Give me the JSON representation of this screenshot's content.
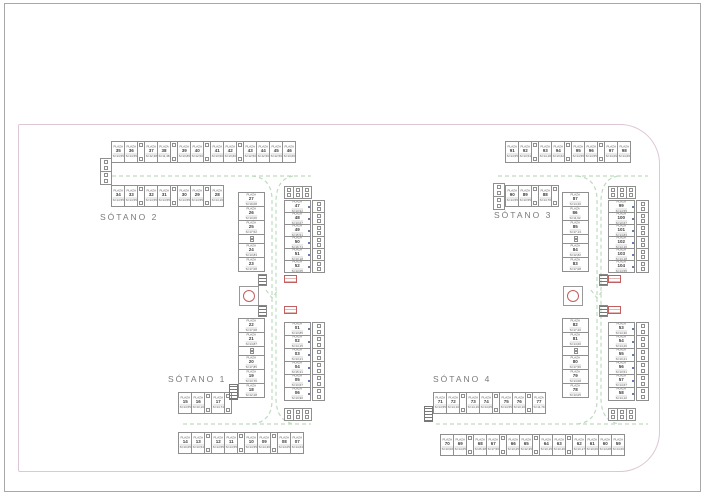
{
  "labels": {
    "s1": "SÓTANO 1",
    "s2": "SÓTANO 2",
    "s3": "SÓTANO 3",
    "s4": "SÓTANO 4"
  },
  "cell_text": {
    "plaza_word": "PLAZA"
  },
  "colors": {
    "background": "#ffffff",
    "frame_border": "#a8a8a8",
    "sheet_border": "#ddc6d6",
    "cell_border": "#8f8f8f",
    "text_dark": "#3e3e3e",
    "text_gray": "#7a7a7a",
    "lane_green": "#bfdbbf",
    "accent_red": "#c25f5f",
    "accent_blue": "#6a79b4"
  },
  "strips": [
    {
      "id": "s2-top-row",
      "x": 111,
      "y": 141,
      "o": "h",
      "cross": 22,
      "pw": 14,
      "uw": 8,
      "cells": [
        {
          "t": "p",
          "n": "35",
          "a": "S=14,55"
        },
        {
          "t": "p",
          "n": "36",
          "a": "S=14,55"
        },
        {
          "t": "u"
        },
        {
          "t": "p",
          "n": "37",
          "a": "S=12,38"
        },
        {
          "t": "p",
          "n": "38",
          "a": "S=11,38"
        },
        {
          "t": "u"
        },
        {
          "t": "p",
          "n": "39",
          "a": "S=13,86"
        },
        {
          "t": "p",
          "n": "40",
          "a": "S=12,50"
        },
        {
          "t": "u"
        },
        {
          "t": "p",
          "n": "41",
          "a": "S=13,50"
        },
        {
          "t": "p",
          "n": "42",
          "a": "S=13,60"
        },
        {
          "t": "u"
        },
        {
          "t": "p",
          "n": "43",
          "a": "S=12,50"
        },
        {
          "t": "p",
          "n": "44",
          "a": "S=12,50"
        },
        {
          "t": "p",
          "n": "45",
          "a": "S=12,50"
        },
        {
          "t": "p",
          "n": "46",
          "a": "S=13,66"
        }
      ]
    },
    {
      "id": "s2-left-block",
      "x": 100,
      "y": 158,
      "o": "v",
      "cross": 12,
      "pw": 14,
      "uw": 14,
      "cells": [
        {
          "t": "u"
        },
        {
          "t": "u"
        }
      ]
    },
    {
      "id": "s2-row-2",
      "x": 111,
      "y": 185,
      "o": "h",
      "cross": 22,
      "pw": 14,
      "uw": 8,
      "cells": [
        {
          "t": "p",
          "n": "34",
          "a": "S=14,55"
        },
        {
          "t": "p",
          "n": "33",
          "a": "S=14,55"
        },
        {
          "t": "u"
        },
        {
          "t": "p",
          "n": "32",
          "a": "S=14,55"
        },
        {
          "t": "p",
          "n": "31",
          "a": "S=14,55"
        },
        {
          "t": "u"
        },
        {
          "t": "p",
          "n": "30",
          "a": "S=14,55"
        },
        {
          "t": "p",
          "n": "29",
          "a": "S=14,55"
        },
        {
          "t": "u"
        },
        {
          "t": "p",
          "n": "28",
          "a": "S=14,16"
        }
      ]
    },
    {
      "id": "s2-col-left",
      "x": 238,
      "y": 192,
      "o": "v",
      "cross": 27,
      "pw": 15,
      "uw": 10,
      "cells": [
        {
          "t": "p",
          "n": "27",
          "a": "S=19,08"
        },
        {
          "t": "p",
          "n": "26",
          "a": "S=13,06"
        },
        {
          "t": "p",
          "n": "25",
          "a": "S=17,52"
        },
        {
          "t": "u"
        },
        {
          "t": "p",
          "n": "24",
          "a": "S=13,83"
        },
        {
          "t": "p",
          "n": "23",
          "a": "S=17,08"
        }
      ]
    },
    {
      "id": "s2-col-utils-top",
      "x": 284,
      "y": 186,
      "o": "h",
      "cross": 13,
      "pw": 10,
      "uw": 10,
      "cells": [
        {
          "t": "u"
        },
        {
          "t": "u"
        },
        {
          "t": "u"
        }
      ]
    },
    {
      "id": "s2-col-right",
      "x": 284,
      "y": 200,
      "o": "v",
      "cross": 27,
      "pw": 13,
      "uw": 8,
      "acc": "blue",
      "cells": [
        {
          "t": "p",
          "n": "47",
          "a": "S=13,92"
        },
        {
          "t": "p",
          "n": "48",
          "a": "S=13,67"
        },
        {
          "t": "p",
          "n": "49",
          "a": "S=15,51"
        },
        {
          "t": "p",
          "n": "50",
          "a": "S=16,71"
        },
        {
          "t": "p",
          "n": "51",
          "a": "S=13,18"
        },
        {
          "t": "p",
          "n": "52",
          "a": "S=13,65"
        }
      ]
    },
    {
      "id": "s2-col-right-utils",
      "x": 312,
      "y": 200,
      "o": "v",
      "cross": 13,
      "pw": 13,
      "uw": 13,
      "cells": [
        {
          "t": "u"
        },
        {
          "t": "u"
        },
        {
          "t": "u"
        },
        {
          "t": "u"
        },
        {
          "t": "u"
        },
        {
          "t": "u"
        }
      ]
    },
    {
      "id": "s1-col-left",
      "x": 238,
      "y": 318,
      "o": "v",
      "cross": 27,
      "pw": 15,
      "uw": 10,
      "cells": [
        {
          "t": "p",
          "n": "22",
          "a": "S=17,08"
        },
        {
          "t": "p",
          "n": "21",
          "a": "S=14,87"
        },
        {
          "t": "u"
        },
        {
          "t": "p",
          "n": "20",
          "a": "S=17,85"
        },
        {
          "t": "p",
          "n": "19",
          "a": "S=13,76"
        },
        {
          "t": "p",
          "n": "18",
          "a": "S=12,28"
        }
      ]
    },
    {
      "id": "s1-col-right",
      "x": 284,
      "y": 322,
      "o": "v",
      "cross": 27,
      "pw": 14,
      "uw": 8,
      "acc": "blue",
      "cells": [
        {
          "t": "p",
          "n": "01",
          "a": "S=13,85"
        },
        {
          "t": "p",
          "n": "02",
          "a": "S=14,15"
        },
        {
          "t": "p",
          "n": "03",
          "a": "S=13,21"
        },
        {
          "t": "p",
          "n": "04",
          "a": "S=15,31"
        },
        {
          "t": "p",
          "n": "05",
          "a": "S=13,67"
        },
        {
          "t": "p",
          "n": "06",
          "a": "S=13,90"
        }
      ]
    },
    {
      "id": "s1-col-right-utils",
      "x": 312,
      "y": 322,
      "o": "v",
      "cross": 13,
      "pw": 14,
      "uw": 14,
      "cells": [
        {
          "t": "u"
        },
        {
          "t": "u"
        },
        {
          "t": "u"
        },
        {
          "t": "u"
        },
        {
          "t": "u"
        },
        {
          "t": "u"
        }
      ]
    },
    {
      "id": "s1-col-bottom-utils",
      "x": 284,
      "y": 408,
      "o": "h",
      "cross": 13,
      "pw": 10,
      "uw": 10,
      "cells": [
        {
          "t": "u"
        },
        {
          "t": "u"
        },
        {
          "t": "u"
        }
      ]
    },
    {
      "id": "s1-row-mid",
      "x": 178,
      "y": 392,
      "o": "h",
      "cross": 22,
      "pw": 14,
      "uw": 8,
      "cells": [
        {
          "t": "p",
          "n": "15",
          "a": "S=14,55"
        },
        {
          "t": "p",
          "n": "16",
          "a": "S=13,10"
        },
        {
          "t": "u"
        },
        {
          "t": "p",
          "n": "17",
          "a": "S=14,74"
        },
        {
          "t": "u"
        }
      ]
    },
    {
      "id": "s1-row-bottom",
      "x": 178,
      "y": 432,
      "o": "h",
      "cross": 22,
      "pw": 14,
      "uw": 8,
      "cells": [
        {
          "t": "p",
          "n": "14",
          "a": "S=13,05"
        },
        {
          "t": "p",
          "n": "13",
          "a": "S=13,54"
        },
        {
          "t": "u"
        },
        {
          "t": "p",
          "n": "12",
          "a": "S=14,55"
        },
        {
          "t": "p",
          "n": "11",
          "a": "S=14,55"
        },
        {
          "t": "u"
        },
        {
          "t": "p",
          "n": "10",
          "a": "S=14,55"
        },
        {
          "t": "p",
          "n": "09",
          "a": "S=14,36"
        },
        {
          "t": "u"
        },
        {
          "t": "p",
          "n": "08",
          "a": "S=14,05"
        },
        {
          "t": "p",
          "n": "07",
          "a": "S=14,64"
        }
      ]
    },
    {
      "id": "s3-top-row",
      "x": 505,
      "y": 141,
      "o": "h",
      "cross": 22,
      "pw": 14,
      "uw": 8,
      "cells": [
        {
          "t": "p",
          "n": "91",
          "a": "S=14,55"
        },
        {
          "t": "p",
          "n": "92",
          "a": "S=13,54"
        },
        {
          "t": "u"
        },
        {
          "t": "p",
          "n": "93",
          "a": "S=14,18"
        },
        {
          "t": "p",
          "n": "94",
          "a": "S=13,62"
        },
        {
          "t": "u"
        },
        {
          "t": "p",
          "n": "95",
          "a": "S=14,55"
        },
        {
          "t": "p",
          "n": "96",
          "a": "S=14,55"
        },
        {
          "t": "u"
        },
        {
          "t": "p",
          "n": "97",
          "a": "S=14,09"
        },
        {
          "t": "p",
          "n": "98",
          "a": "S=14,66"
        }
      ]
    },
    {
      "id": "s3-left-block",
      "x": 493,
      "y": 183,
      "o": "v",
      "cross": 12,
      "pw": 14,
      "uw": 14,
      "cells": [
        {
          "t": "u"
        },
        {
          "t": "u"
        }
      ]
    },
    {
      "id": "s3-row-2",
      "x": 505,
      "y": 185,
      "o": "h",
      "cross": 22,
      "pw": 14,
      "uw": 8,
      "cells": [
        {
          "t": "p",
          "n": "90",
          "a": "S=14,55"
        },
        {
          "t": "p",
          "n": "89",
          "a": "S=13,55"
        },
        {
          "t": "u"
        },
        {
          "t": "p",
          "n": "88",
          "a": "S=14,76"
        },
        {
          "t": "u"
        }
      ]
    },
    {
      "id": "s3-col-left",
      "x": 562,
      "y": 192,
      "o": "v",
      "cross": 27,
      "pw": 15,
      "uw": 10,
      "cells": [
        {
          "t": "p",
          "n": "87",
          "a": "S=14,20"
        },
        {
          "t": "p",
          "n": "86",
          "a": "S=11,62"
        },
        {
          "t": "p",
          "n": "85",
          "a": "S=17,13"
        },
        {
          "t": "u"
        },
        {
          "t": "p",
          "n": "84",
          "a": "S=12,82"
        },
        {
          "t": "p",
          "n": "83",
          "a": "S=17,08"
        }
      ]
    },
    {
      "id": "s3-col-utils-top",
      "x": 608,
      "y": 186,
      "o": "h",
      "cross": 13,
      "pw": 10,
      "uw": 10,
      "cells": [
        {
          "t": "u"
        },
        {
          "t": "u"
        },
        {
          "t": "u"
        }
      ]
    },
    {
      "id": "s3-col-right",
      "x": 608,
      "y": 200,
      "o": "v",
      "cross": 27,
      "pw": 13,
      "uw": 8,
      "acc": "blue",
      "cells": [
        {
          "t": "p",
          "n": "99",
          "a": "S=14,55"
        },
        {
          "t": "p",
          "n": "100",
          "a": "S=13,67"
        },
        {
          "t": "p",
          "n": "101",
          "a": "S=14,83"
        },
        {
          "t": "p",
          "n": "102",
          "a": "S=14,16"
        },
        {
          "t": "p",
          "n": "103",
          "a": "S=14,18"
        },
        {
          "t": "p",
          "n": "104",
          "a": "S=14,55"
        }
      ]
    },
    {
      "id": "s3-col-right-utils",
      "x": 636,
      "y": 200,
      "o": "v",
      "cross": 13,
      "pw": 13,
      "uw": 13,
      "cells": [
        {
          "t": "u"
        },
        {
          "t": "u"
        },
        {
          "t": "u"
        },
        {
          "t": "u"
        },
        {
          "t": "u"
        },
        {
          "t": "u"
        }
      ]
    },
    {
      "id": "s4-col-left",
      "x": 562,
      "y": 318,
      "o": "v",
      "cross": 27,
      "pw": 15,
      "uw": 10,
      "cells": [
        {
          "t": "p",
          "n": "82",
          "a": "S=17,20"
        },
        {
          "t": "p",
          "n": "81",
          "a": "S=14,60"
        },
        {
          "t": "u"
        },
        {
          "t": "p",
          "n": "80",
          "a": "S=17,56"
        },
        {
          "t": "p",
          "n": "79",
          "a": "S=14,08"
        },
        {
          "t": "p",
          "n": "78",
          "a": "S=13,05"
        }
      ]
    },
    {
      "id": "s4-col-right",
      "x": 608,
      "y": 322,
      "o": "v",
      "cross": 27,
      "pw": 14,
      "uw": 8,
      "acc": "blue",
      "cells": [
        {
          "t": "p",
          "n": "53",
          "a": "S=14,30"
        },
        {
          "t": "p",
          "n": "54",
          "a": "S=14,20"
        },
        {
          "t": "p",
          "n": "55",
          "a": "S=13,21"
        },
        {
          "t": "p",
          "n": "56",
          "a": "S=13,51"
        },
        {
          "t": "p",
          "n": "57",
          "a": "S=14,67"
        },
        {
          "t": "p",
          "n": "58",
          "a": "S=14,12"
        }
      ]
    },
    {
      "id": "s4-col-right-utils",
      "x": 636,
      "y": 322,
      "o": "v",
      "cross": 13,
      "pw": 14,
      "uw": 14,
      "cells": [
        {
          "t": "u"
        },
        {
          "t": "u"
        },
        {
          "t": "u"
        },
        {
          "t": "u"
        },
        {
          "t": "u"
        },
        {
          "t": "u"
        }
      ]
    },
    {
      "id": "s4-col-bottom-utils",
      "x": 608,
      "y": 408,
      "o": "h",
      "cross": 13,
      "pw": 10,
      "uw": 10,
      "cells": [
        {
          "t": "u"
        },
        {
          "t": "u"
        },
        {
          "t": "u"
        }
      ]
    },
    {
      "id": "s4-row-mid",
      "x": 433,
      "y": 392,
      "o": "h",
      "cross": 22,
      "pw": 14,
      "uw": 8,
      "cells": [
        {
          "t": "p",
          "n": "71",
          "a": "S=14,55"
        },
        {
          "t": "p",
          "n": "72",
          "a": "S=14,10"
        },
        {
          "t": "u"
        },
        {
          "t": "p",
          "n": "73",
          "a": "S=14,16"
        },
        {
          "t": "p",
          "n": "74",
          "a": "S=14,05"
        },
        {
          "t": "u"
        },
        {
          "t": "p",
          "n": "75",
          "a": "S=14,55"
        },
        {
          "t": "p",
          "n": "76",
          "a": "S=13,10"
        },
        {
          "t": "u"
        },
        {
          "t": "p",
          "n": "77",
          "a": "S=11,79"
        }
      ]
    },
    {
      "id": "s4-row-bottom",
      "x": 440,
      "y": 434,
      "o": "h",
      "cross": 22,
      "pw": 14,
      "uw": 8,
      "cells": [
        {
          "t": "p",
          "n": "70",
          "a": "S=13,00"
        },
        {
          "t": "p",
          "n": "69",
          "a": "S=14,05"
        },
        {
          "t": "u"
        },
        {
          "t": "p",
          "n": "68",
          "a": "S=26,38"
        },
        {
          "t": "p",
          "n": "67",
          "a": "S=17,50"
        },
        {
          "t": "u"
        },
        {
          "t": "p",
          "n": "66",
          "a": "S=13,25"
        },
        {
          "t": "p",
          "n": "65",
          "a": "S=12,35"
        },
        {
          "t": "u"
        },
        {
          "t": "p",
          "n": "64",
          "a": "S=13,15"
        },
        {
          "t": "p",
          "n": "63",
          "a": "S=13,46"
        },
        {
          "t": "u"
        },
        {
          "t": "p",
          "n": "62",
          "a": "S=13,17"
        },
        {
          "t": "p",
          "n": "61",
          "a": "S=13,06"
        },
        {
          "t": "p",
          "n": "60",
          "a": "S=14,08"
        },
        {
          "t": "p",
          "n": "59",
          "a": "S=14,66"
        }
      ]
    }
  ],
  "symbols": [
    {
      "t": "elevator",
      "x": 239,
      "y": 286
    },
    {
      "t": "stairs",
      "x": 258,
      "y": 274
    },
    {
      "t": "redbox",
      "x": 284,
      "y": 275
    },
    {
      "t": "stairs",
      "x": 258,
      "y": 305
    },
    {
      "t": "redbox",
      "x": 284,
      "y": 306
    },
    {
      "t": "entry",
      "x": 229,
      "y": 384
    },
    {
      "t": "elevator",
      "x": 563,
      "y": 286
    },
    {
      "t": "stairs",
      "x": 599,
      "y": 274
    },
    {
      "t": "redbox",
      "x": 608,
      "y": 275
    },
    {
      "t": "stairs",
      "x": 599,
      "y": 305
    },
    {
      "t": "redbox",
      "x": 608,
      "y": 306
    },
    {
      "t": "entry",
      "x": 424,
      "y": 406
    }
  ]
}
